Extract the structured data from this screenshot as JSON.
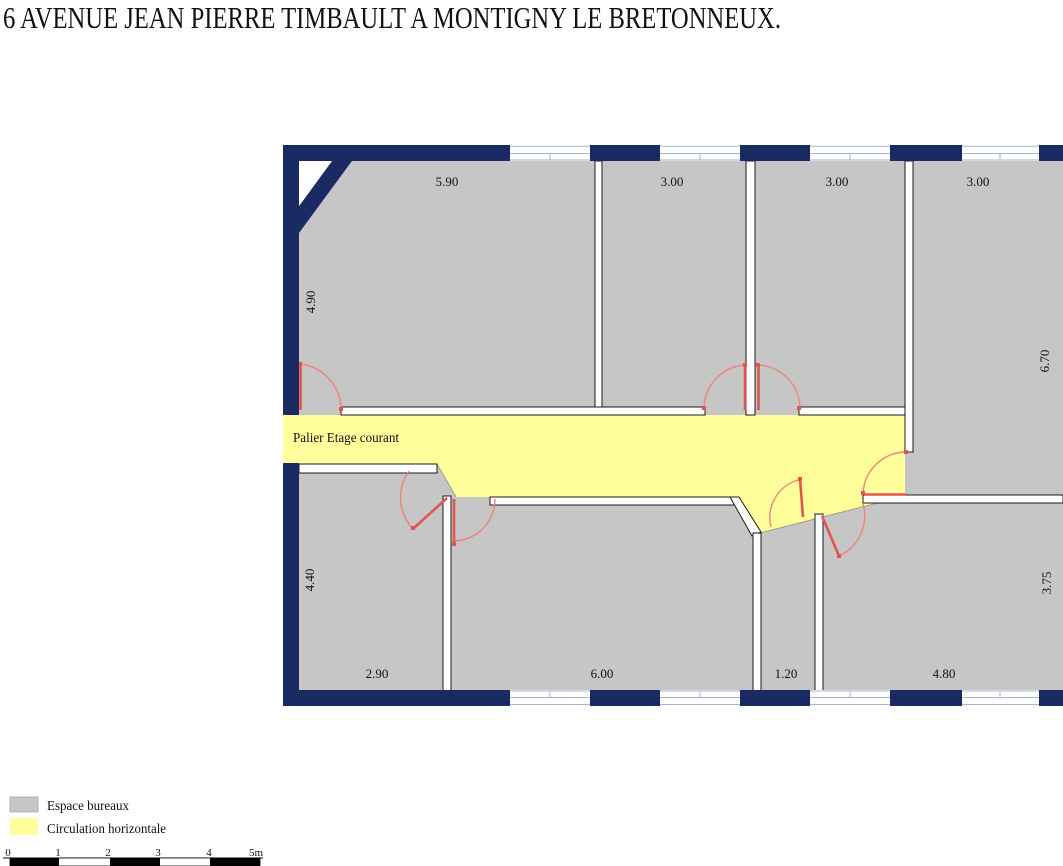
{
  "title": "6 AVENUE JEAN PIERRE TIMBAULT A MONTIGNY LE BRETONNEUX.",
  "plan": {
    "corridor_label": "Palier Etage courant",
    "dims": {
      "top1": "5.90",
      "top2": "3.00",
      "top3": "3.00",
      "top4": "3.00",
      "left1": "4.90",
      "left2": "4.40",
      "right1": "6.70",
      "right2": "3.75",
      "bottom1": "2.90",
      "bottom2": "6.00",
      "bottom3": "1.20",
      "bottom4": "4.80"
    }
  },
  "legend": {
    "items": [
      {
        "label": "Espace bureaux",
        "color": "#c6c6c6"
      },
      {
        "label": "Circulation horizontale",
        "color": "#ffff9c"
      }
    ]
  },
  "scale_bar": {
    "labels": {
      "l0": "0",
      "l1": "1",
      "l2": "2",
      "l3": "3",
      "l4": "4",
      "l5": "5m"
    }
  },
  "colors": {
    "wall_navy": "#1a2b64",
    "room_gray": "#c6c6c6",
    "corridor_yellow": "#ffff9c",
    "door_leaf": "#e0564e",
    "door_arc": "#ef837a",
    "window_frame": "#a9b3ce"
  }
}
